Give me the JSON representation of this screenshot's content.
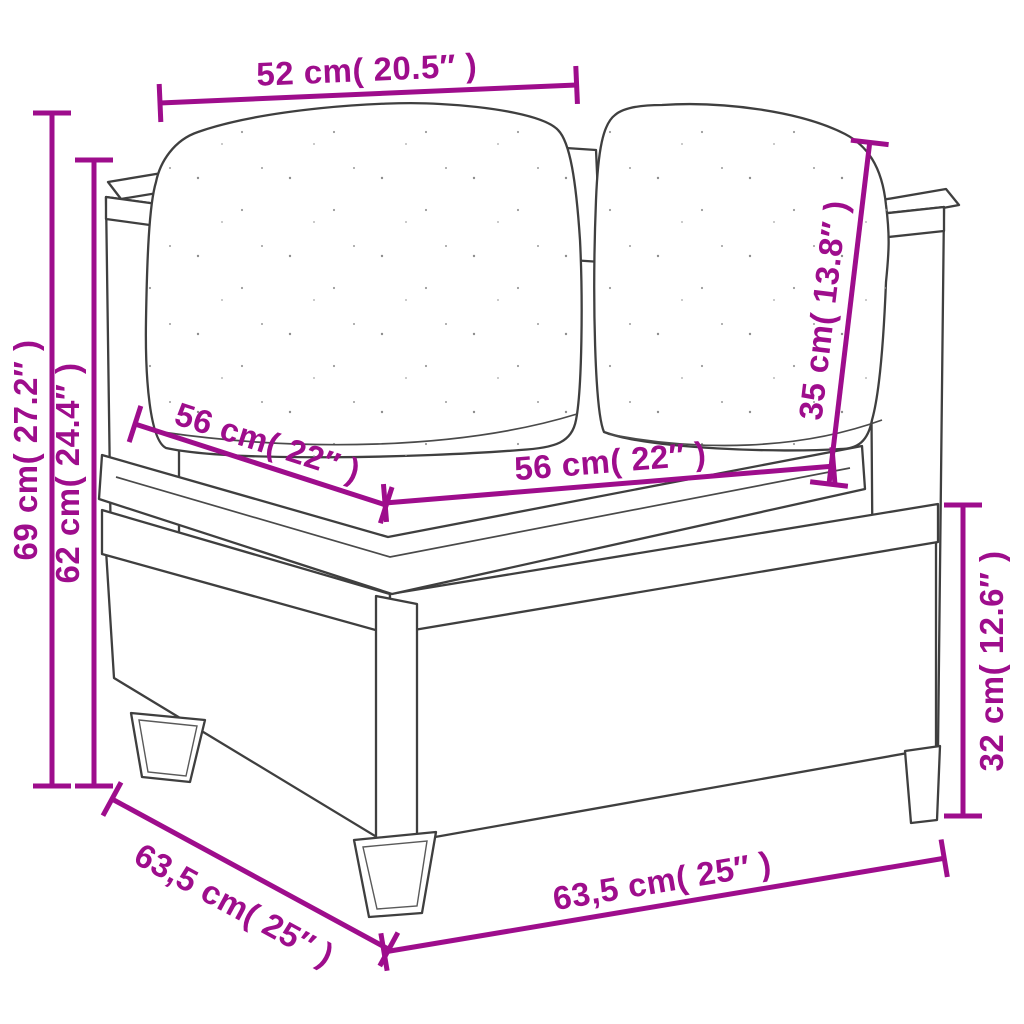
{
  "diagram": {
    "type": "furniture-dimension-diagram",
    "subject": "poly rattan corner sofa section with seat cushion and two back cushions",
    "colors": {
      "dimension_magenta": "#9E0D8C",
      "line_art_gray": "#3F3F3F",
      "background": "#FFFFFF"
    },
    "dimensions": {
      "top_width": {
        "text": "52 cm( 20.5″ )",
        "cm": "52",
        "inches": "20.5"
      },
      "height_total": {
        "text": "69 cm( 27.2″ )",
        "cm": "69",
        "inches": "27.2"
      },
      "height_to_armrest": {
        "text": "62 cm( 24.4″ )",
        "cm": "62",
        "inches": "24.4"
      },
      "seat_depth": {
        "text": "56 cm( 22″ )",
        "cm": "56",
        "inches": "22"
      },
      "seat_width": {
        "text": "56 cm( 22″ )",
        "cm": "56",
        "inches": "22"
      },
      "back_cushion_height": {
        "text": "35 cm( 13.8″ )",
        "cm": "35",
        "inches": "13.8"
      },
      "base_height": {
        "text": "32 cm( 12.6″ )",
        "cm": "32",
        "inches": "12.6"
      },
      "depth_total": {
        "text": "63,5 cm( 25″ )",
        "cm": "63,5",
        "inches": "25"
      },
      "width_total": {
        "text": "63,5 cm( 25″ )",
        "cm": "63,5",
        "inches": "25"
      }
    }
  }
}
